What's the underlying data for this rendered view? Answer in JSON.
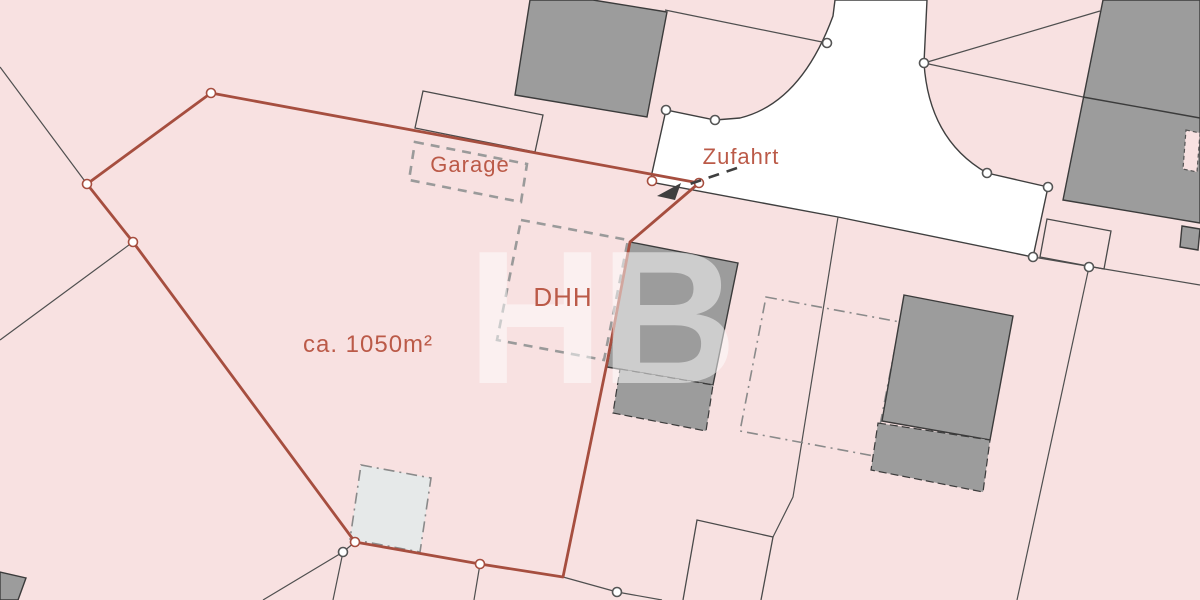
{
  "map": {
    "title": "Lageplan",
    "labels": {
      "garage": "Garage",
      "zufahrt": "Zufahrt",
      "dhh": "DHH",
      "area": "ca. 1050m²"
    },
    "watermark": "HB",
    "colors": {
      "background_pink": "#f8e1e1",
      "road_white": "#ffffff",
      "building_gray": "#9c9c9c",
      "light_square_gray": "#e6e9e9",
      "boundary_red": "#a64e3f",
      "label_red": "#bb5a48",
      "parcel_line_gray": "#4f4f4f",
      "dashed_gray": "#9a9a9a"
    }
  }
}
